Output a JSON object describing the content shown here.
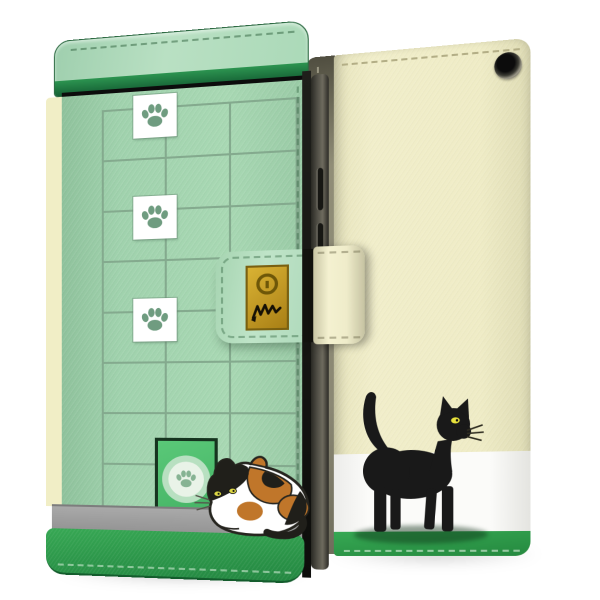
{
  "scene": {
    "kind": "product-photo",
    "subject": "flip wallet smartphone case, cat theme, front and back views",
    "background_color": "#ffffff",
    "text_visible": false
  },
  "front_case": {
    "view": "front-closed",
    "design": {
      "motif": "green window lattice with climbing paw prints and cat door",
      "lattice_columns": 3,
      "lattice_rows": 8,
      "paw_tiles": 3,
      "door_emblem": "paw-print-in-circle",
      "cat": {
        "kind": "calico",
        "pose": "crouching",
        "facing": "left",
        "patch_colors": [
          "#ffffff",
          "#201f1a",
          "#c0762a"
        ],
        "eye_color": "#ded845"
      }
    },
    "strap": {
      "plate_motifs": [
        "keyhole-circle",
        "scratch-scribble"
      ],
      "closure": "wrap strap over front edge"
    }
  },
  "back_case": {
    "view": "back",
    "design": {
      "bands": [
        "cream",
        "white",
        "green"
      ],
      "camera_hole": true,
      "cat": {
        "kind": "black",
        "pose": "walking",
        "facing": "right",
        "color": "#191919",
        "eye_color": "#e8e23c",
        "tail": "raised"
      }
    },
    "spine_stitching": true
  },
  "colors": {
    "cream_edge": "#f1eec6",
    "front_flap": "#b9e0c3",
    "front_flap_trim": "#156034",
    "front_panel": "#a0d2ad",
    "lattice": "#84aa8e",
    "paw": "#6f9c80",
    "door": "#3fae60",
    "door_border": "#16341f",
    "baseboard": "#939393",
    "front_band": "#238741",
    "strap_base": "#bfe4c8",
    "strap_side": "#f4f1d0",
    "plate": "#bd9422",
    "back_body": "#f1eeca",
    "back_white": "#fbfbf9",
    "back_band": "#25893f",
    "spine": "#908d77",
    "cat_black": "#191919",
    "cat_orange": "#c0762a",
    "eye_yellow": "#e8e23c"
  }
}
